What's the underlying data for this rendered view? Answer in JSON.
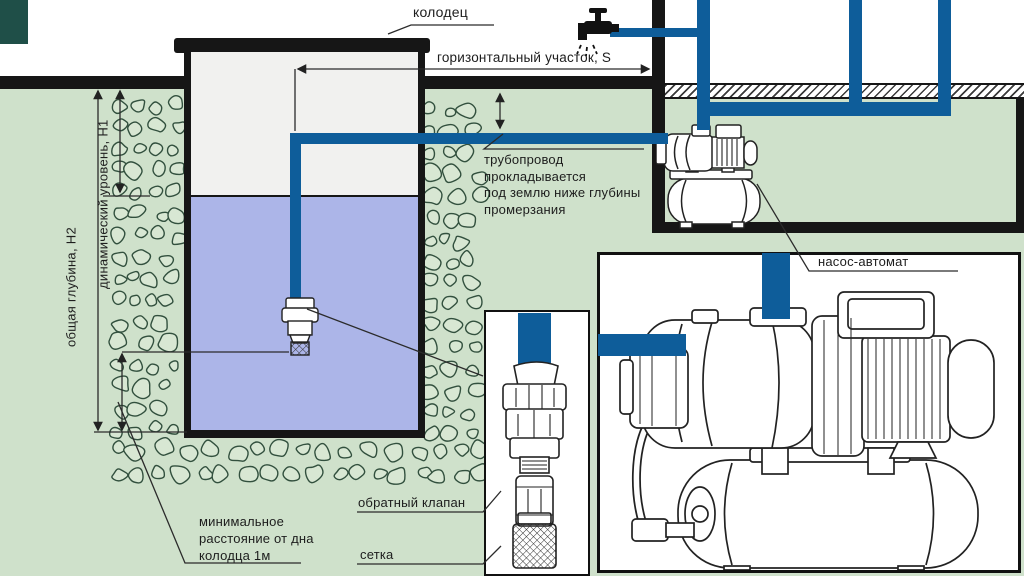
{
  "diagram": {
    "labels": {
      "well": "колодец",
      "horizontal_section": "горизонтальный участок, S",
      "pipe_note": "трубопровод\nпрокладывается\nпод землю ниже глубины\nпромерзания",
      "total_depth": "общая глубина, Н2",
      "dynamic_level": "динамический уровень, Н1",
      "min_distance": "минимальное\nрасстояние от дна\nколодца 1м",
      "check_valve": "обратный клапан",
      "strainer": "сетка",
      "pump_station": "насос-автомат"
    },
    "colors": {
      "pipe_blue": "#0e5d9a",
      "water": "#acb5e8",
      "earth_green": "#cfe1cb",
      "well_interior": "#f1f1ef",
      "outline_black": "#161616",
      "stone_outline": "#32503e",
      "stone_fill": "#d8e7d3",
      "corner_teal": "#1f4f48"
    },
    "icons": {
      "faucet": "faucet-icon",
      "pump_small": "pump-station-small-illustration",
      "pump_large": "pump-station-large-illustration",
      "valve_detail": "check-valve-strainer-illustration"
    }
  }
}
